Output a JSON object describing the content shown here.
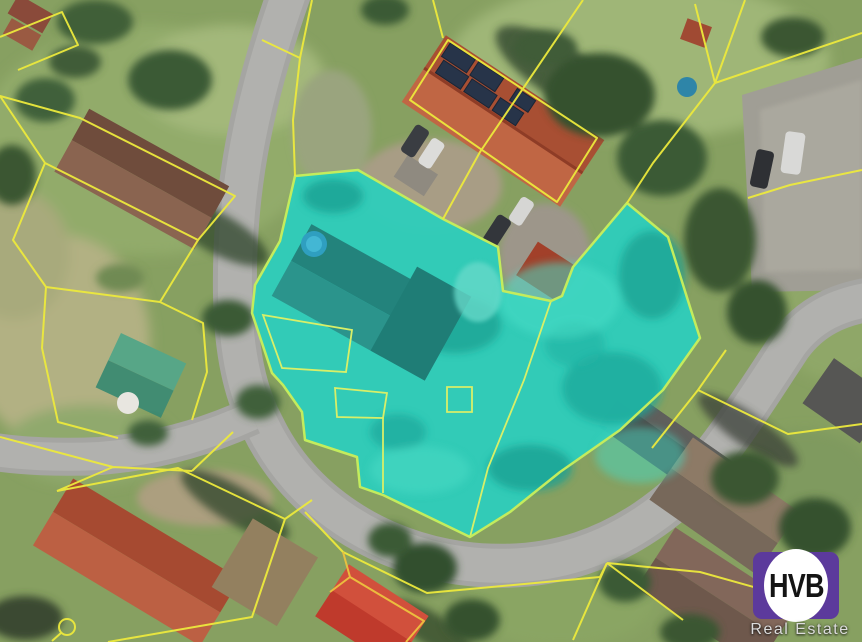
{
  "window": {
    "width": 862,
    "height": 642,
    "kind": "real-estate aerial cadastral map screenshot"
  },
  "logo": {
    "text": "HVB",
    "subtext": "Real Estate",
    "square_color": "#5c3a9c",
    "circle_color": "#ffffff",
    "text_color": "#141414",
    "subtext_color": "#dcdcdc"
  },
  "map": {
    "description": "aerial photo with yellow cadastral parcel boundaries and one teal highlighted property",
    "cadastral_line_color": "#ece93d",
    "road_color": "#aeaeab",
    "highlight": {
      "fill": "#2fcdba",
      "border": "#c3ec5d",
      "polygon": "295,176 358,170 443,219 498,247 503,291 551,301 562,296 573,267 627,203 668,237 690,307 700,338 663,390 620,430 560,472 510,512 470,537 383,495 360,487 357,457 305,440 302,412 283,385 272,373 252,313 255,285 280,241",
      "inner_parcels": [
        "263,315 352,330 346,372 282,368",
        "335,388 387,393 383,418 337,417",
        "447,387 472,387 472,412 447,412"
      ],
      "inner_lines": [
        "551,301 524,380 488,468 470,537",
        "383,418 383,493"
      ]
    }
  }
}
